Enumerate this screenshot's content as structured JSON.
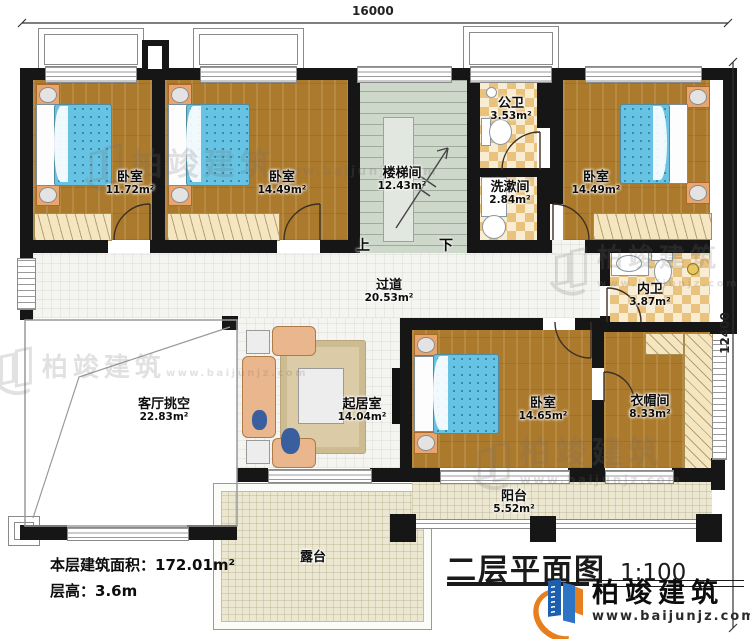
{
  "plan": {
    "title": "二层平面图",
    "scale": "1:100",
    "dimensions": {
      "top": "16000",
      "right": "12400"
    },
    "stair": {
      "up": "上",
      "down": "下"
    },
    "rooms": [
      {
        "id": "bedroom-1",
        "name": "卧室",
        "area": "11.72m²"
      },
      {
        "id": "bedroom-2",
        "name": "卧室",
        "area": "14.49m²"
      },
      {
        "id": "stairwell",
        "name": "楼梯间",
        "area": "12.43m²"
      },
      {
        "id": "public-bath",
        "name": "公卫",
        "area": "3.53m²"
      },
      {
        "id": "washroom",
        "name": "洗漱间",
        "area": "2.84m²"
      },
      {
        "id": "bedroom-3",
        "name": "卧室",
        "area": "14.49m²"
      },
      {
        "id": "ensuite-bath",
        "name": "内卫",
        "area": "3.87m²"
      },
      {
        "id": "hallway",
        "name": "过道",
        "area": "20.53m²"
      },
      {
        "id": "living-void",
        "name": "客厅挑空",
        "area": "22.83m²"
      },
      {
        "id": "family-room",
        "name": "起居室",
        "area": "14.04m²"
      },
      {
        "id": "bedroom-4",
        "name": "卧室",
        "area": "14.65m²"
      },
      {
        "id": "cloakroom",
        "name": "衣帽间",
        "area": "8.33m²"
      },
      {
        "id": "balcony",
        "name": "阳台",
        "area": "5.52m²"
      },
      {
        "id": "terrace",
        "name": "露台",
        "area": ""
      }
    ],
    "stats": {
      "area_label": "本层建筑面积：",
      "area_value": "172.01m²",
      "height_label": "层高：",
      "height_value": "3.6m"
    },
    "watermark": {
      "brand": "柏竣建筑",
      "url": "www.baijunjz.com"
    },
    "logo": {
      "brand": "柏竣建筑",
      "url": "www.baijunjz.com"
    },
    "colors": {
      "brand_blue": "#1c5fae",
      "brand_orange": "#e87f1d",
      "wall": "#161616"
    }
  }
}
